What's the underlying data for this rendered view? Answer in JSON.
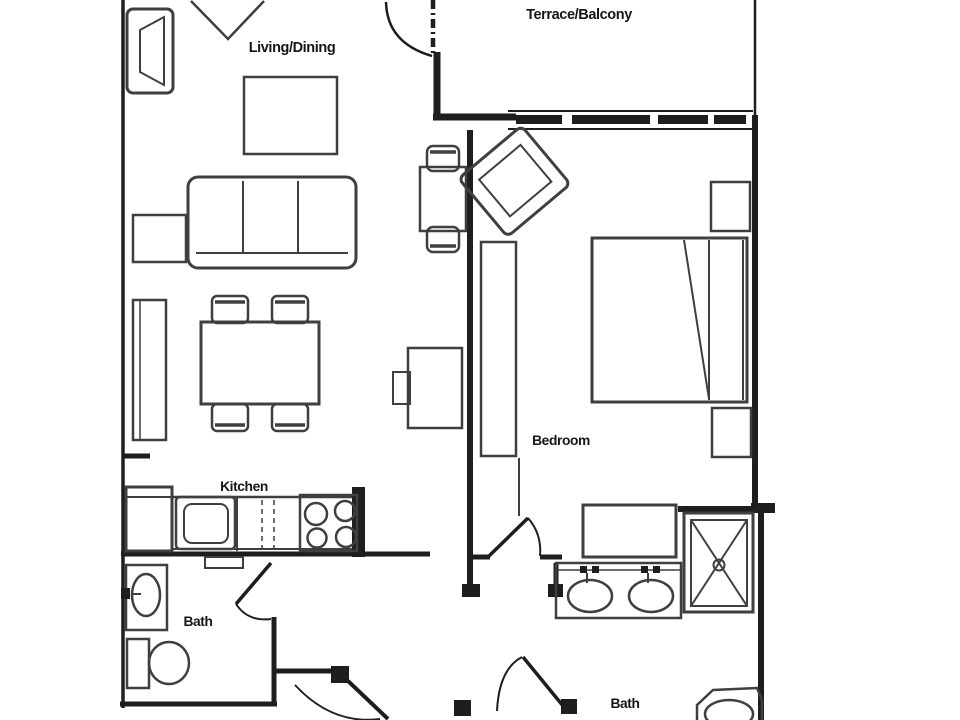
{
  "title": "Apartment floor plan",
  "rooms": {
    "terrace_balcony": {
      "label": "Terrace/Balcony"
    },
    "living_dining": {
      "label": "Living/Dining"
    },
    "bedroom": {
      "label": "Bedroom"
    },
    "kitchen": {
      "label": "Kitchen"
    },
    "bath_main": {
      "label": "Bath"
    },
    "bath_second": {
      "label": "Bath"
    }
  },
  "colors": {
    "wall": "#1e1e1e",
    "furniture_line": "#3f3f3f",
    "label_text": "#161616",
    "background": "#ffffff",
    "window_pane": "#1e1e1e"
  },
  "furniture_items": [
    "armchair",
    "corner-unit",
    "coffee-table",
    "sofa",
    "side-table",
    "bookshelf",
    "dining-table",
    "dining-chair",
    "bistro-table",
    "bistro-chair",
    "desk",
    "desk-chair",
    "lounge-chair",
    "wardrobe",
    "double-bed",
    "nightstand",
    "dresser",
    "refrigerator",
    "kitchen-sink",
    "dishwasher",
    "stove",
    "vanity-sink",
    "toilet",
    "double-vanity",
    "shower",
    "window-band",
    "swing-door"
  ]
}
